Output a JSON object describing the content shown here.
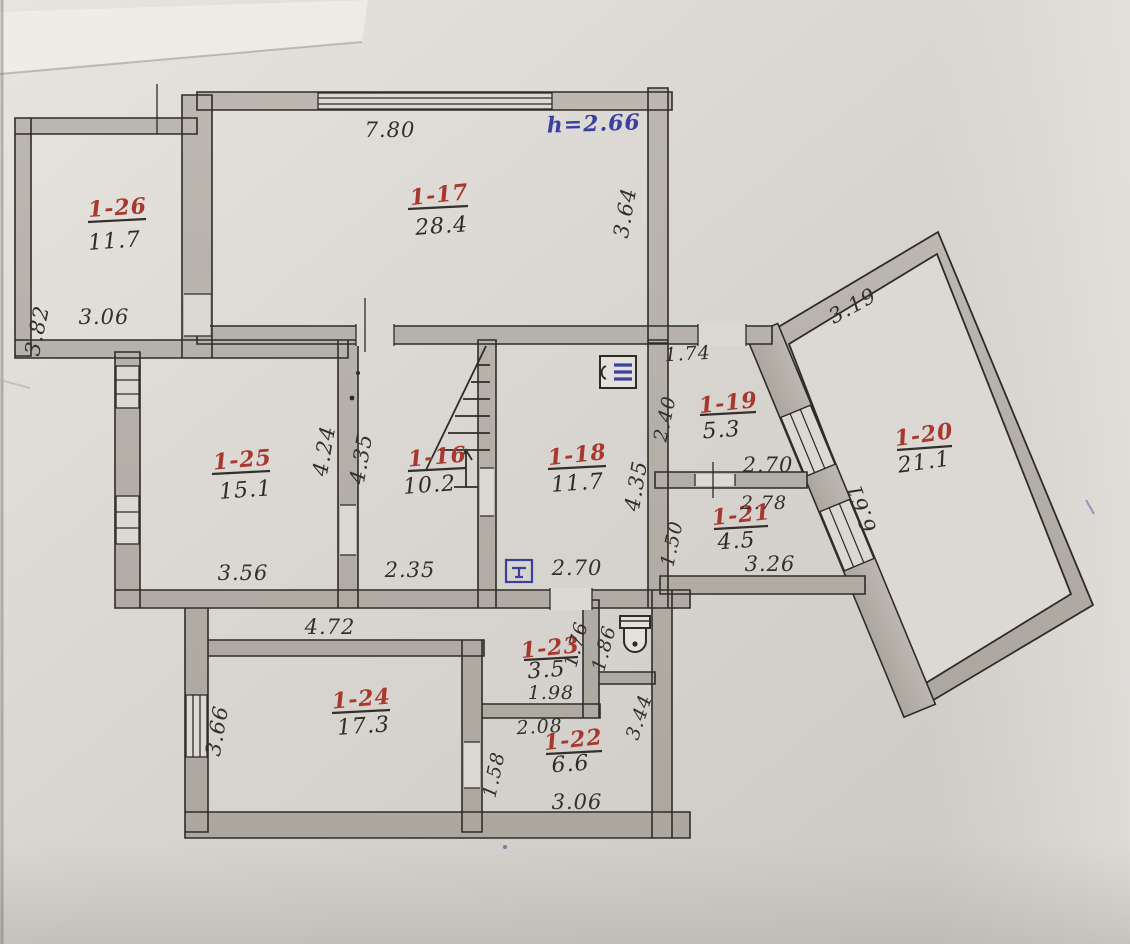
{
  "plan": {
    "note_height": "h=2.66",
    "colors": {
      "ink": "#33302b",
      "room_red": "#a8382e",
      "pen_blue": "#3c3f9e",
      "pencil_wall": "#b6b2ab",
      "paper": "#dcd8d3"
    },
    "icons": {
      "stairs": "stairs-with-up-arrow",
      "boiler": "boiler-icon",
      "meter": "gas-meter-icon",
      "toilet": "toilet-icon"
    },
    "rooms": {
      "r17": {
        "id": "1-17",
        "area": "28.4",
        "dim_top": "7.80",
        "dim_right": "3.64"
      },
      "r26": {
        "id": "1-26",
        "area": "11.7",
        "dim_left": "3.82",
        "dim_bottom": "3.06"
      },
      "r25": {
        "id": "1-25",
        "area": "15.1",
        "dim_right": "4.24",
        "dim_bottom": "3.56"
      },
      "r16": {
        "id": "1-16",
        "area": "10.2",
        "dim_left": "4.35",
        "dim_bottom": "2.35"
      },
      "r18": {
        "id": "1-18",
        "area": "11.7",
        "dim_right": "4.35",
        "dim_bottom": "2.70"
      },
      "r19": {
        "id": "1-19",
        "area": "5.3",
        "dim_top": "1.74",
        "dim_left": "2.40",
        "dim_bottom": "2.70"
      },
      "r21": {
        "id": "1-21",
        "area": "4.5",
        "dim_top": "2.78",
        "dim_left": "1.50",
        "dim_bottom": "3.26"
      },
      "r20": {
        "id": "1-20",
        "area": "21.1",
        "dim_top": "3.19",
        "dim_side": "6.61"
      },
      "r24": {
        "id": "1-24",
        "area": "17.3",
        "dim_top": "4.72",
        "dim_left": "3.66"
      },
      "r23": {
        "id": "1-23",
        "area": "3.5",
        "dim_right": "1.76",
        "dim_bottom": "1.98"
      },
      "r22": {
        "id": "1-22",
        "area": "6.6",
        "dim_top": "2.08",
        "dim_left": "1.58",
        "dim_right": "3.44",
        "dim_bottom": "3.06"
      },
      "wc": {
        "dim_side": "1.86"
      }
    }
  }
}
